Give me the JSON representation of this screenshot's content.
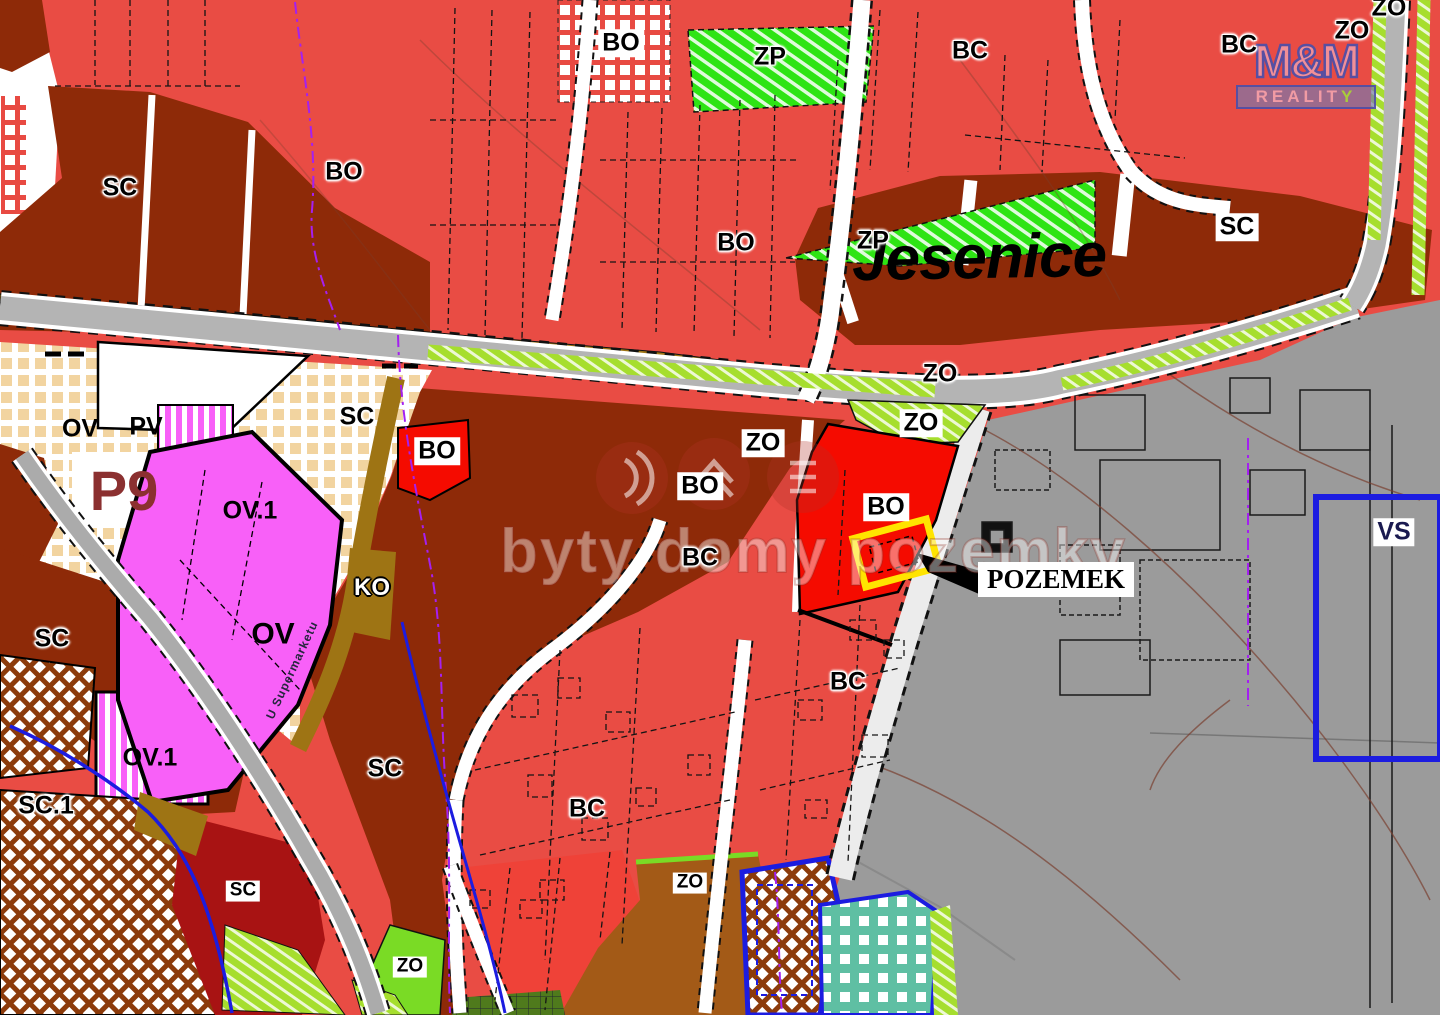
{
  "map": {
    "place_name": "Jesenice",
    "watermark_text": "byty domy pozemky",
    "street_name": "U Supermarketu",
    "callout_label": "POZEMEK",
    "logo": {
      "line1": "M&M",
      "line2": "REALIT",
      "line2_accent": "Y"
    },
    "zone_labels": [
      {
        "text": "SC",
        "x": 120,
        "y": 188,
        "style": "halo"
      },
      {
        "text": "BO",
        "x": 344,
        "y": 172,
        "style": "halo"
      },
      {
        "text": "BO",
        "x": 621,
        "y": 43,
        "style": "box"
      },
      {
        "text": "ZP",
        "x": 770,
        "y": 57,
        "style": "halo"
      },
      {
        "text": "BC",
        "x": 970,
        "y": 51,
        "style": "halo"
      },
      {
        "text": "BC",
        "x": 1239,
        "y": 45,
        "style": "halo"
      },
      {
        "text": "ZO",
        "x": 1389,
        "y": 8,
        "style": "halo"
      },
      {
        "text": "ZO",
        "x": 1352,
        "y": 31,
        "style": "halo"
      },
      {
        "text": "BO",
        "x": 736,
        "y": 243,
        "style": "halo"
      },
      {
        "text": "ZP",
        "x": 873,
        "y": 241,
        "style": "halo"
      },
      {
        "text": "SC",
        "x": 1237,
        "y": 227,
        "style": "box"
      },
      {
        "text": "SC",
        "x": 357,
        "y": 417,
        "style": "halo"
      },
      {
        "text": "BO",
        "x": 437,
        "y": 451,
        "style": "box"
      },
      {
        "text": "ZO",
        "x": 940,
        "y": 374,
        "style": "halo"
      },
      {
        "text": "ZO",
        "x": 763,
        "y": 443,
        "style": "box"
      },
      {
        "text": "BO",
        "x": 700,
        "y": 486,
        "style": "box"
      },
      {
        "text": "ZO",
        "x": 921,
        "y": 423,
        "style": "box"
      },
      {
        "text": "BO",
        "x": 886,
        "y": 507,
        "style": "box"
      },
      {
        "text": "BC",
        "x": 700,
        "y": 558,
        "style": "halo"
      },
      {
        "text": "VS",
        "x": 1394,
        "y": 532,
        "style": "box-navy"
      },
      {
        "text": "OV",
        "x": 80,
        "y": 429,
        "style": "plain"
      },
      {
        "text": "PV",
        "x": 146,
        "y": 427,
        "style": "plain"
      },
      {
        "text": "P9",
        "x": 124,
        "y": 491,
        "style": "p9"
      },
      {
        "text": "OV.1",
        "x": 250,
        "y": 511,
        "style": "plain"
      },
      {
        "text": "OV",
        "x": 273,
        "y": 634,
        "style": "plain lg"
      },
      {
        "text": "KO",
        "x": 372,
        "y": 588,
        "style": "white-outline"
      },
      {
        "text": "SC",
        "x": 52,
        "y": 639,
        "style": "halo"
      },
      {
        "text": "SC.1",
        "x": 46,
        "y": 806,
        "style": "halo"
      },
      {
        "text": "OV.1",
        "x": 150,
        "y": 758,
        "style": "plain"
      },
      {
        "text": "SC",
        "x": 385,
        "y": 769,
        "style": "halo"
      },
      {
        "text": "BC",
        "x": 587,
        "y": 809,
        "style": "halo"
      },
      {
        "text": "BC",
        "x": 848,
        "y": 682,
        "style": "halo"
      },
      {
        "text": "ZO",
        "x": 690,
        "y": 883,
        "style": "box sm"
      },
      {
        "text": "ZO",
        "x": 410,
        "y": 967,
        "style": "box sm"
      },
      {
        "text": "SC",
        "x": 243,
        "y": 891,
        "style": "box sm"
      }
    ],
    "colors": {
      "residential_red": "#E94C44",
      "vivid_red_parcel_zone": "#F50B00",
      "mixed_sc_brown": "#8E2A08",
      "sc_dark_red": "#A81313",
      "built_area_gray": "#9B9B9B",
      "zp_green": "#2EE414",
      "zo_green": "#A6DE2E",
      "ov_magenta": "#F860F8",
      "reserve_tan": "#F2D4A0",
      "teal_zone": "#5FBFA3",
      "chocolate_zone": "#A35A17",
      "road_olive": "#9E7414",
      "boundary_blue": "#1C1CE0",
      "utility_purple": "#A420F0",
      "highlight_yellow": "#FFE400"
    }
  }
}
